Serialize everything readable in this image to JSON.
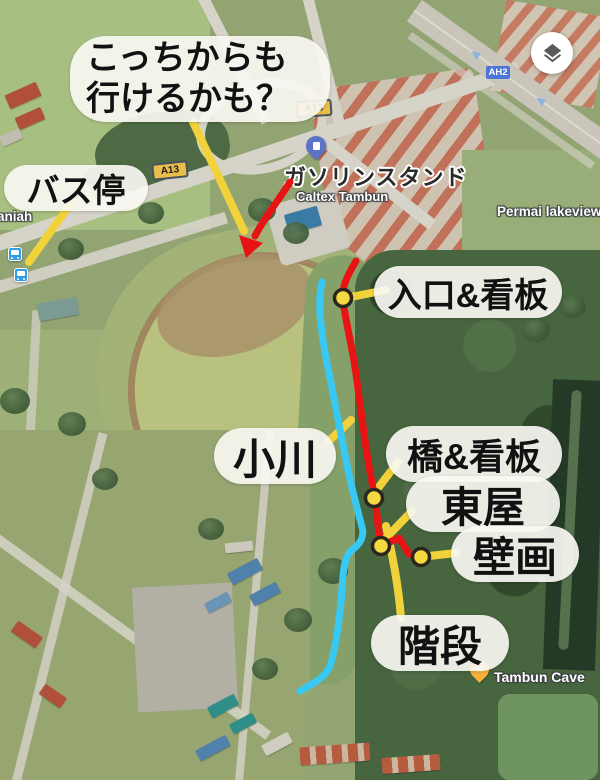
{
  "colors": {
    "route_red": "#e81414",
    "stream_cyan": "#38c8f4",
    "annotation_yellow": "#f2d23a",
    "marker_fill": "#f6d840",
    "marker_ring": "#2a2620",
    "bubble_bg": "rgba(248,247,242,0.92)",
    "bubble_text": "#111111",
    "badge_a13_bg": "#e9bd4b",
    "badge_ah2_bg": "#4a74d8"
  },
  "annotations": {
    "speech_bubble": {
      "line1": "こっちからも",
      "line2": "行けるかも？"
    },
    "labels": {
      "bus_stop": "バス停",
      "entrance": "入口&看板",
      "stream": "小川",
      "bridge": "橋&看板",
      "gazebo": "東屋",
      "mural": "壁画",
      "stairs": "階段"
    }
  },
  "map": {
    "poi": {
      "gas_station_jp": "ガソリンスタンド",
      "caltex": "Caltex Tambun",
      "permai_lakeview": "Permai lakeview",
      "saniah_partial": "aniah",
      "tambun_cave": "Tambun Cave"
    },
    "badges": {
      "a13_upper": "A13",
      "a13_lower": "A13",
      "ah2": "AH2"
    }
  }
}
